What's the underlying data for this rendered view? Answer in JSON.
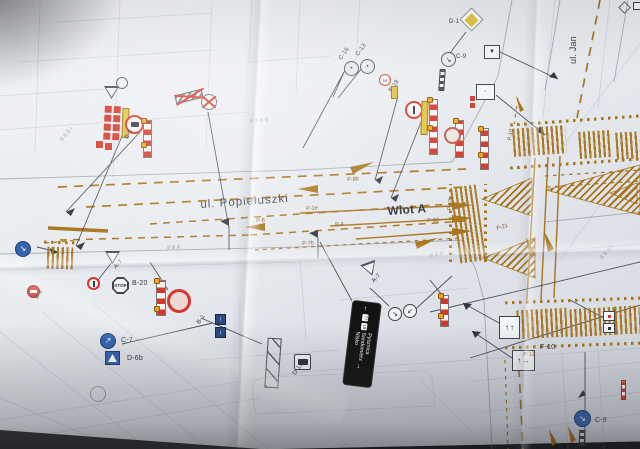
{
  "colors": {
    "background": "#3a3b40",
    "paper": "#e9ecf0",
    "marking_orange": "#a8741c",
    "barrier_red": "#d3372b",
    "lamp_orange": "#efa21f",
    "sign_blue": "#3365af",
    "accent_yellow": "#e3c23c",
    "ink": "#33373f"
  },
  "streets": {
    "main": "ul. Popiełuszki",
    "approach": "Wlot A",
    "side": "ul. Jan"
  },
  "direction_sign": {
    "destinations": [
      "Pysznica",
      "Sandomierz",
      "Nisko"
    ],
    "routes": [
      "77",
      "19"
    ]
  },
  "signs": {
    "c7": "C-7",
    "d6b": "D-6b",
    "b20": "B-20",
    "stop": "STOP",
    "c9": "C-9",
    "a7": "A-7",
    "d1": "D-1",
    "f10": "F-10",
    "b2": "B-2",
    "b1": "B-1",
    "b5": "B-5",
    "b18": "B-18",
    "b18_value": "10",
    "c16": "C-16",
    "c13": "C-13",
    "d15": "D-15"
  },
  "markings": {
    "p_labels": [
      "P-8b",
      "P-1e",
      "P-6",
      "P-4",
      "P-7b",
      "P-8d",
      "P-10",
      "P-21",
      "P-10",
      "P-12"
    ]
  }
}
